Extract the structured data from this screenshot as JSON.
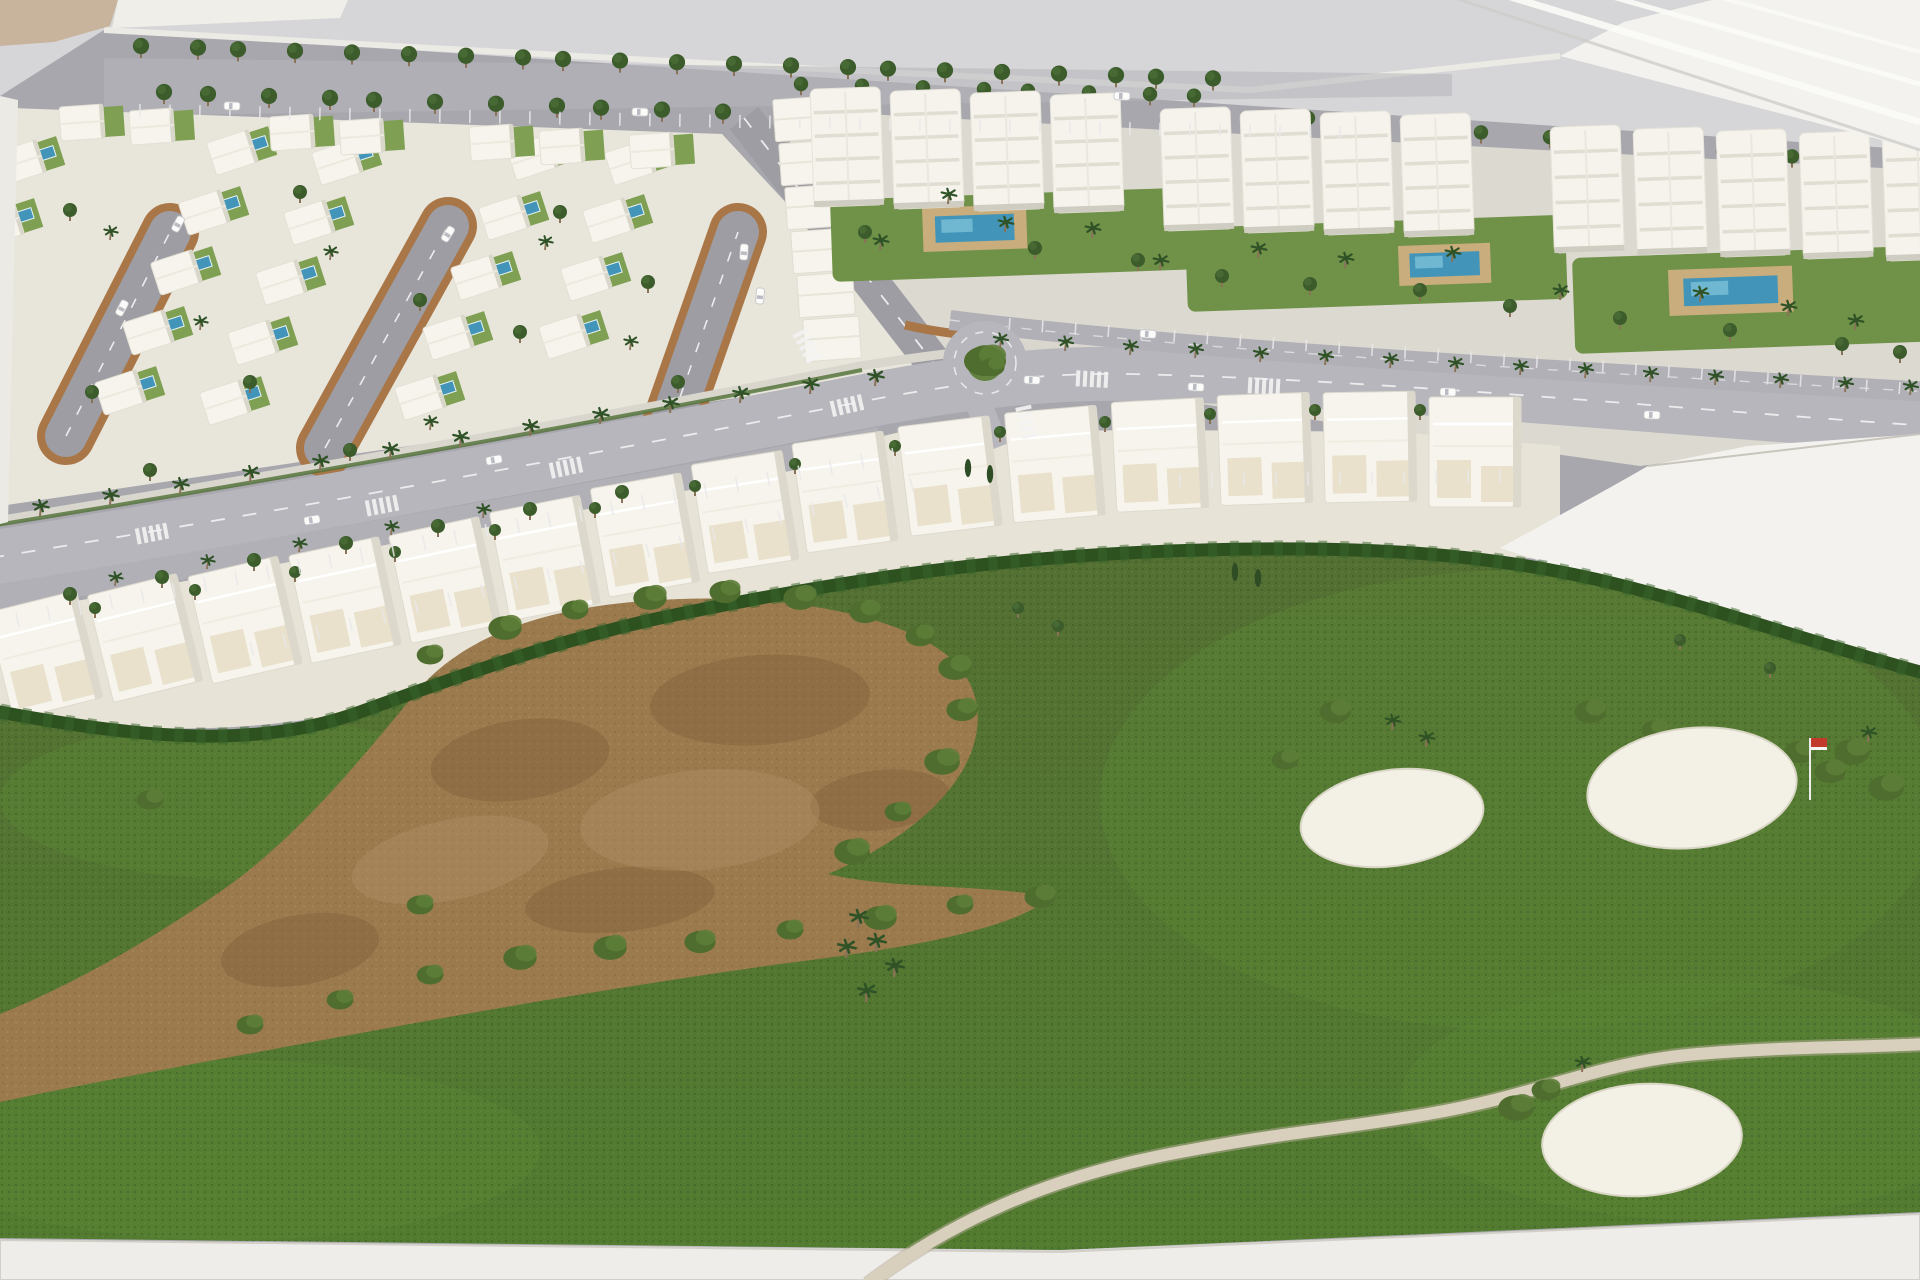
{
  "meta": {
    "label": "Photograph of an architectural scale model of a golf resort masterplan with villas, apartment blocks, palm-lined avenue and golf course"
  },
  "palette": {
    "bg": "#d6d6d8",
    "backdropWhite": "#f3f2ee",
    "streak": "#fbfbf8",
    "streakGrey": "#cfcecb",
    "beige": "#c8b49d",
    "rim": "#eceae4",
    "ground": "#a7a7ad",
    "roadLight": "#b6b6bc",
    "roadDash": "#ececee",
    "sidewalk": "#d9d6ce",
    "parkLane": "#b0b0b6",
    "plot": "#e8e5da",
    "plotTown": "#e7e3d7",
    "loopRim": "#a97647",
    "loopRoad": "#9d9da3",
    "villa": "#f6f4ec",
    "villaShade": "#d9d6ca",
    "lawn": "#7fa053",
    "lawnDark": "#6f9148",
    "pool": "#4295b8",
    "poolLight": "#7cc0d8",
    "deck": "#c9ad7c",
    "apt": "#f5f3ec",
    "aptLine": "#e0ddd3",
    "aptShade": "#cfccc2",
    "treeDark": "#3c5c2c",
    "treeLite": "#4e7238",
    "palm": "#2f5226",
    "trunk": "#8a7258",
    "hedge": "#2d5220",
    "bush1": "#4e6d2e",
    "bush2": "#5d7d38",
    "grassTop": "#546f33",
    "grassBot": "#527c30",
    "grassLight": "#5c8636",
    "dirt": "#9b7a4e",
    "dirtDark": "#7e5c38",
    "dirtLight": "#b3926a",
    "path": "#d8cfbd",
    "pathEdge": "#b8ad97",
    "bunker": "#f3f1e6",
    "bunkerEdge": "#d9d6c6",
    "flagRed": "#c23b2a",
    "base": "#efede9",
    "baseEdge": "#d2cfc8",
    "car": "#fbfbfa",
    "carGlass": "#b9bcc2"
  },
  "scene": {
    "tree_rows": [
      {
        "x0": 130,
        "x1": 1240,
        "step": 54,
        "y0": 46,
        "slope": 0.03,
        "r": 9
      },
      {
        "x0": 150,
        "x1": 760,
        "step": 56,
        "y0": 92,
        "slope": 0.035,
        "r": 9
      },
      {
        "x0": 800,
        "x1": 1240,
        "step": 56,
        "y0": 84,
        "slope": 0.03,
        "r": 8
      },
      {
        "x0": 1300,
        "x1": 1900,
        "step": 60,
        "y0": 118,
        "slope": 0.08,
        "r": 8
      }
    ],
    "loops": [
      {
        "x1": 66,
        "y1": 436,
        "x2": 170,
        "y2": 232
      },
      {
        "x1": 325,
        "y1": 448,
        "x2": 448,
        "y2": 226
      },
      {
        "x1": 672,
        "y1": 420,
        "x2": 738,
        "y2": 232
      }
    ],
    "villas": [
      [
        28,
        160,
        1,
        -18
      ],
      [
        6,
        222,
        1,
        -18
      ],
      [
        240,
        150,
        1,
        -18
      ],
      [
        212,
        210,
        1,
        -18
      ],
      [
        184,
        270,
        1,
        -18
      ],
      [
        156,
        330,
        1,
        -18
      ],
      [
        128,
        390,
        1,
        -18
      ],
      [
        345,
        160,
        1,
        -18
      ],
      [
        317,
        220,
        1,
        -18
      ],
      [
        289,
        280,
        1,
        -18
      ],
      [
        261,
        340,
        1,
        -18
      ],
      [
        233,
        400,
        1,
        -18
      ],
      [
        540,
        155,
        1,
        -18
      ],
      [
        512,
        215,
        1,
        -18
      ],
      [
        484,
        275,
        1,
        -18
      ],
      [
        456,
        335,
        1,
        -18
      ],
      [
        428,
        395,
        1,
        -18
      ],
      [
        638,
        160,
        1,
        -18
      ],
      [
        616,
        218,
        1,
        -18
      ],
      [
        594,
        276,
        1,
        -18
      ],
      [
        572,
        334,
        1,
        -18
      ],
      [
        90,
        122,
        0,
        -4
      ],
      [
        160,
        126,
        0,
        -4
      ],
      [
        300,
        132,
        0,
        -4
      ],
      [
        370,
        136,
        0,
        -4
      ],
      [
        500,
        142,
        0,
        -4
      ],
      [
        570,
        146,
        0,
        -4
      ],
      [
        660,
        150,
        0,
        -4
      ]
    ],
    "villa_trees": [
      [
        70,
        210
      ],
      [
        300,
        192
      ],
      [
        420,
        300
      ],
      [
        250,
        382
      ],
      [
        520,
        332
      ],
      [
        648,
        282
      ],
      [
        678,
        382
      ],
      [
        92,
        392
      ],
      [
        560,
        212
      ],
      [
        350,
        450
      ],
      [
        150,
        470
      ]
    ],
    "villa_palms": [
      [
        110,
        240
      ],
      [
        330,
        260
      ],
      [
        545,
        250
      ],
      [
        630,
        350
      ],
      [
        200,
        330
      ],
      [
        430,
        430
      ]
    ],
    "vcolumn": [
      [
        800,
        118
      ],
      [
        806,
        162
      ],
      [
        812,
        206
      ],
      [
        818,
        250
      ],
      [
        824,
        294
      ],
      [
        830,
        338
      ]
    ],
    "apt_clusters": [
      {
        "x0": 845,
        "y": 88,
        "dx": 80,
        "n": 4,
        "h": 118,
        "rot": -2
      },
      {
        "x0": 1195,
        "y": 108,
        "dx": 80,
        "n": 4,
        "h": 122,
        "rot": -2
      },
      {
        "x0": 1585,
        "y": 126,
        "dx": 83,
        "n": 5,
        "h": 126,
        "rot": -2
      }
    ],
    "gardens": [
      [
        830,
        200,
        360,
        82
      ],
      [
        1185,
        228,
        380,
        84
      ],
      [
        1572,
        258,
        362,
        96
      ]
    ],
    "apt_pools": [
      [
        922,
        208,
        104,
        44
      ],
      [
        1398,
        246,
        92,
        40
      ],
      [
        1668,
        270,
        124,
        46
      ]
    ],
    "garden_palms": [
      [
        948,
        204
      ],
      [
        1005,
        232
      ],
      [
        1092,
        238
      ],
      [
        1258,
        258
      ],
      [
        1345,
        268
      ],
      [
        1452,
        262
      ],
      [
        1560,
        300
      ],
      [
        1700,
        302
      ],
      [
        1788,
        316
      ],
      [
        1855,
        330
      ],
      [
        880,
        250
      ],
      [
        1160,
        270
      ]
    ],
    "apt_trees": [
      [
        865,
        232
      ],
      [
        1035,
        248
      ],
      [
        1138,
        260
      ],
      [
        1222,
        276
      ],
      [
        1310,
        284
      ],
      [
        1420,
        290
      ],
      [
        1510,
        306
      ],
      [
        1620,
        318
      ],
      [
        1730,
        330
      ],
      [
        1842,
        344
      ],
      [
        1900,
        352
      ]
    ],
    "townhouses": [
      [
        45,
        655,
        -14
      ],
      [
        145,
        638,
        -14
      ],
      [
        245,
        620,
        -13
      ],
      [
        345,
        600,
        -12
      ],
      [
        445,
        580,
        -12
      ],
      [
        545,
        558,
        -11
      ],
      [
        645,
        535,
        -10
      ],
      [
        745,
        512,
        -9
      ],
      [
        845,
        492,
        -8
      ],
      [
        950,
        476,
        -7
      ],
      [
        1055,
        464,
        -5
      ],
      [
        1160,
        455,
        -3
      ],
      [
        1265,
        449,
        -2
      ],
      [
        1370,
        447,
        -1
      ],
      [
        1475,
        452,
        0
      ]
    ],
    "town_trees": [
      [
        95,
        608
      ],
      [
        195,
        590
      ],
      [
        295,
        572
      ],
      [
        395,
        552
      ],
      [
        495,
        530
      ],
      [
        595,
        508
      ],
      [
        695,
        486
      ],
      [
        795,
        464
      ],
      [
        895,
        446
      ],
      [
        1000,
        432
      ],
      [
        1105,
        422
      ],
      [
        1210,
        414
      ],
      [
        1315,
        410
      ],
      [
        1420,
        410
      ]
    ],
    "avenue_palms_left": [
      [
        40,
        516
      ],
      [
        110,
        505
      ],
      [
        180,
        494
      ],
      [
        250,
        482
      ],
      [
        320,
        471
      ],
      [
        390,
        459
      ],
      [
        460,
        447
      ],
      [
        530,
        436
      ],
      [
        600,
        424
      ],
      [
        670,
        413
      ],
      [
        740,
        403
      ],
      [
        810,
        394
      ],
      [
        875,
        386
      ]
    ],
    "avenue_palms_right": [
      [
        1000,
        348
      ],
      [
        1065,
        351
      ],
      [
        1130,
        355
      ],
      [
        1195,
        358
      ],
      [
        1260,
        362
      ],
      [
        1325,
        365
      ],
      [
        1390,
        368
      ],
      [
        1455,
        372
      ],
      [
        1520,
        375
      ],
      [
        1585,
        378
      ],
      [
        1650,
        382
      ],
      [
        1715,
        385
      ],
      [
        1780,
        388
      ],
      [
        1845,
        392
      ],
      [
        1910,
        395
      ]
    ],
    "avenue_trees_lower": [
      [
        70,
        594
      ],
      [
        162,
        577
      ],
      [
        254,
        560
      ],
      [
        346,
        543
      ],
      [
        438,
        526
      ],
      [
        530,
        509
      ],
      [
        622,
        492
      ]
    ],
    "avenue_palms_lower": [
      [
        115,
        586
      ],
      [
        207,
        569
      ],
      [
        299,
        552
      ],
      [
        391,
        535
      ],
      [
        483,
        518
      ]
    ],
    "parking_bands": [
      {
        "x1": 140,
        "y1": 104,
        "x2": 1340,
        "y2": 126,
        "n": 40,
        "len": 13
      },
      {
        "x1": 16,
        "y1": 612,
        "x2": 892,
        "y2": 448,
        "n": 28,
        "len": 15
      },
      {
        "x1": 1010,
        "y1": 318,
        "x2": 1900,
        "y2": 382,
        "n": 27,
        "len": 12
      },
      {
        "x1": 250,
        "y1": 642,
        "x2": 910,
        "y2": 478,
        "n": 20,
        "len": 14
      },
      {
        "x1": 1180,
        "y1": 474,
        "x2": 1500,
        "y2": 470,
        "n": 10,
        "len": 13
      }
    ],
    "cars": [
      [
        232,
        106,
        2
      ],
      [
        640,
        112,
        2
      ],
      [
        1122,
        96,
        2
      ],
      [
        178,
        224,
        -62
      ],
      [
        122,
        308,
        -62
      ],
      [
        448,
        234,
        -58
      ],
      [
        744,
        252,
        -86
      ],
      [
        760,
        296,
        -86
      ],
      [
        312,
        520,
        -10
      ],
      [
        494,
        460,
        -11
      ],
      [
        1032,
        380,
        3
      ],
      [
        1196,
        387,
        3
      ],
      [
        1652,
        415,
        2
      ],
      [
        1148,
        334,
        3
      ],
      [
        1448,
        392,
        2
      ]
    ],
    "crosswalks": [
      [
        150,
        534,
        -11
      ],
      [
        380,
        506,
        -11
      ],
      [
        564,
        468,
        -12
      ],
      [
        845,
        406,
        -13
      ],
      [
        1026,
        420,
        78
      ],
      [
        1090,
        379,
        3
      ],
      [
        1262,
        386,
        3
      ],
      [
        806,
        344,
        62
      ]
    ],
    "roundabout": {
      "cx": 985,
      "cy": 363,
      "r_outer": 42,
      "r_ring": 31,
      "r_island": 18
    },
    "golf": {
      "bunkers": [
        [
          1392,
          818,
          92,
          48,
          -8
        ],
        [
          1692,
          788,
          105,
          60,
          -6
        ],
        [
          1642,
          1140,
          100,
          56,
          -4
        ]
      ],
      "flag": {
        "x": 1810,
        "y": 800,
        "pole": 62
      },
      "bushes": [
        [
          430,
          655
        ],
        [
          505,
          628
        ],
        [
          575,
          610
        ],
        [
          650,
          598
        ],
        [
          725,
          592
        ],
        [
          800,
          598
        ],
        [
          865,
          612
        ],
        [
          920,
          636
        ],
        [
          955,
          668
        ],
        [
          962,
          710
        ],
        [
          942,
          762
        ],
        [
          898,
          812
        ],
        [
          852,
          852
        ],
        [
          250,
          1025
        ],
        [
          340,
          1000
        ],
        [
          430,
          975
        ],
        [
          520,
          958
        ],
        [
          610,
          948
        ],
        [
          700,
          942
        ],
        [
          790,
          930
        ],
        [
          880,
          918
        ],
        [
          960,
          905
        ],
        [
          1040,
          897
        ],
        [
          1285,
          760
        ],
        [
          1335,
          712
        ],
        [
          1590,
          712
        ],
        [
          1655,
          730
        ],
        [
          1725,
          745
        ],
        [
          1800,
          752
        ],
        [
          1852,
          752
        ],
        [
          1886,
          788
        ],
        [
          1830,
          772
        ],
        [
          1546,
          1090
        ],
        [
          1576,
          1114
        ],
        [
          1516,
          1108
        ],
        [
          150,
          800
        ],
        [
          420,
          905
        ]
      ],
      "palms_small": [
        [
          1392,
          730
        ],
        [
          1426,
          747
        ],
        [
          1582,
          1072
        ],
        [
          1868,
          742
        ]
      ],
      "palm_cluster": [
        [
          858,
          928
        ],
        [
          876,
          952
        ],
        [
          894,
          977
        ],
        [
          866,
          1002
        ],
        [
          846,
          958
        ]
      ],
      "trees": [
        [
          1018,
          608
        ],
        [
          1058,
          626
        ],
        [
          1680,
          640
        ],
        [
          1770,
          668
        ]
      ],
      "cypresses": [
        [
          968,
          468
        ],
        [
          990,
          474
        ],
        [
          1235,
          572
        ],
        [
          1258,
          578
        ]
      ],
      "dirt_patches": [
        [
          520,
          760,
          90,
          40,
          -8,
          "dark"
        ],
        [
          760,
          700,
          110,
          45,
          -4,
          "dark"
        ],
        [
          880,
          800,
          70,
          30,
          -6,
          "dark"
        ],
        [
          300,
          950,
          80,
          35,
          -10,
          "dark"
        ],
        [
          620,
          900,
          95,
          32,
          -6,
          "dark"
        ],
        [
          700,
          820,
          120,
          50,
          -5,
          "light"
        ],
        [
          450,
          860,
          100,
          40,
          -12,
          "light"
        ]
      ],
      "grass_lights": [
        [
          1520,
          800,
          420,
          230
        ],
        [
          1700,
          1100,
          300,
          120
        ],
        [
          230,
          1150,
          310,
          90
        ],
        [
          250,
          800,
          250,
          80
        ]
      ]
    }
  }
}
